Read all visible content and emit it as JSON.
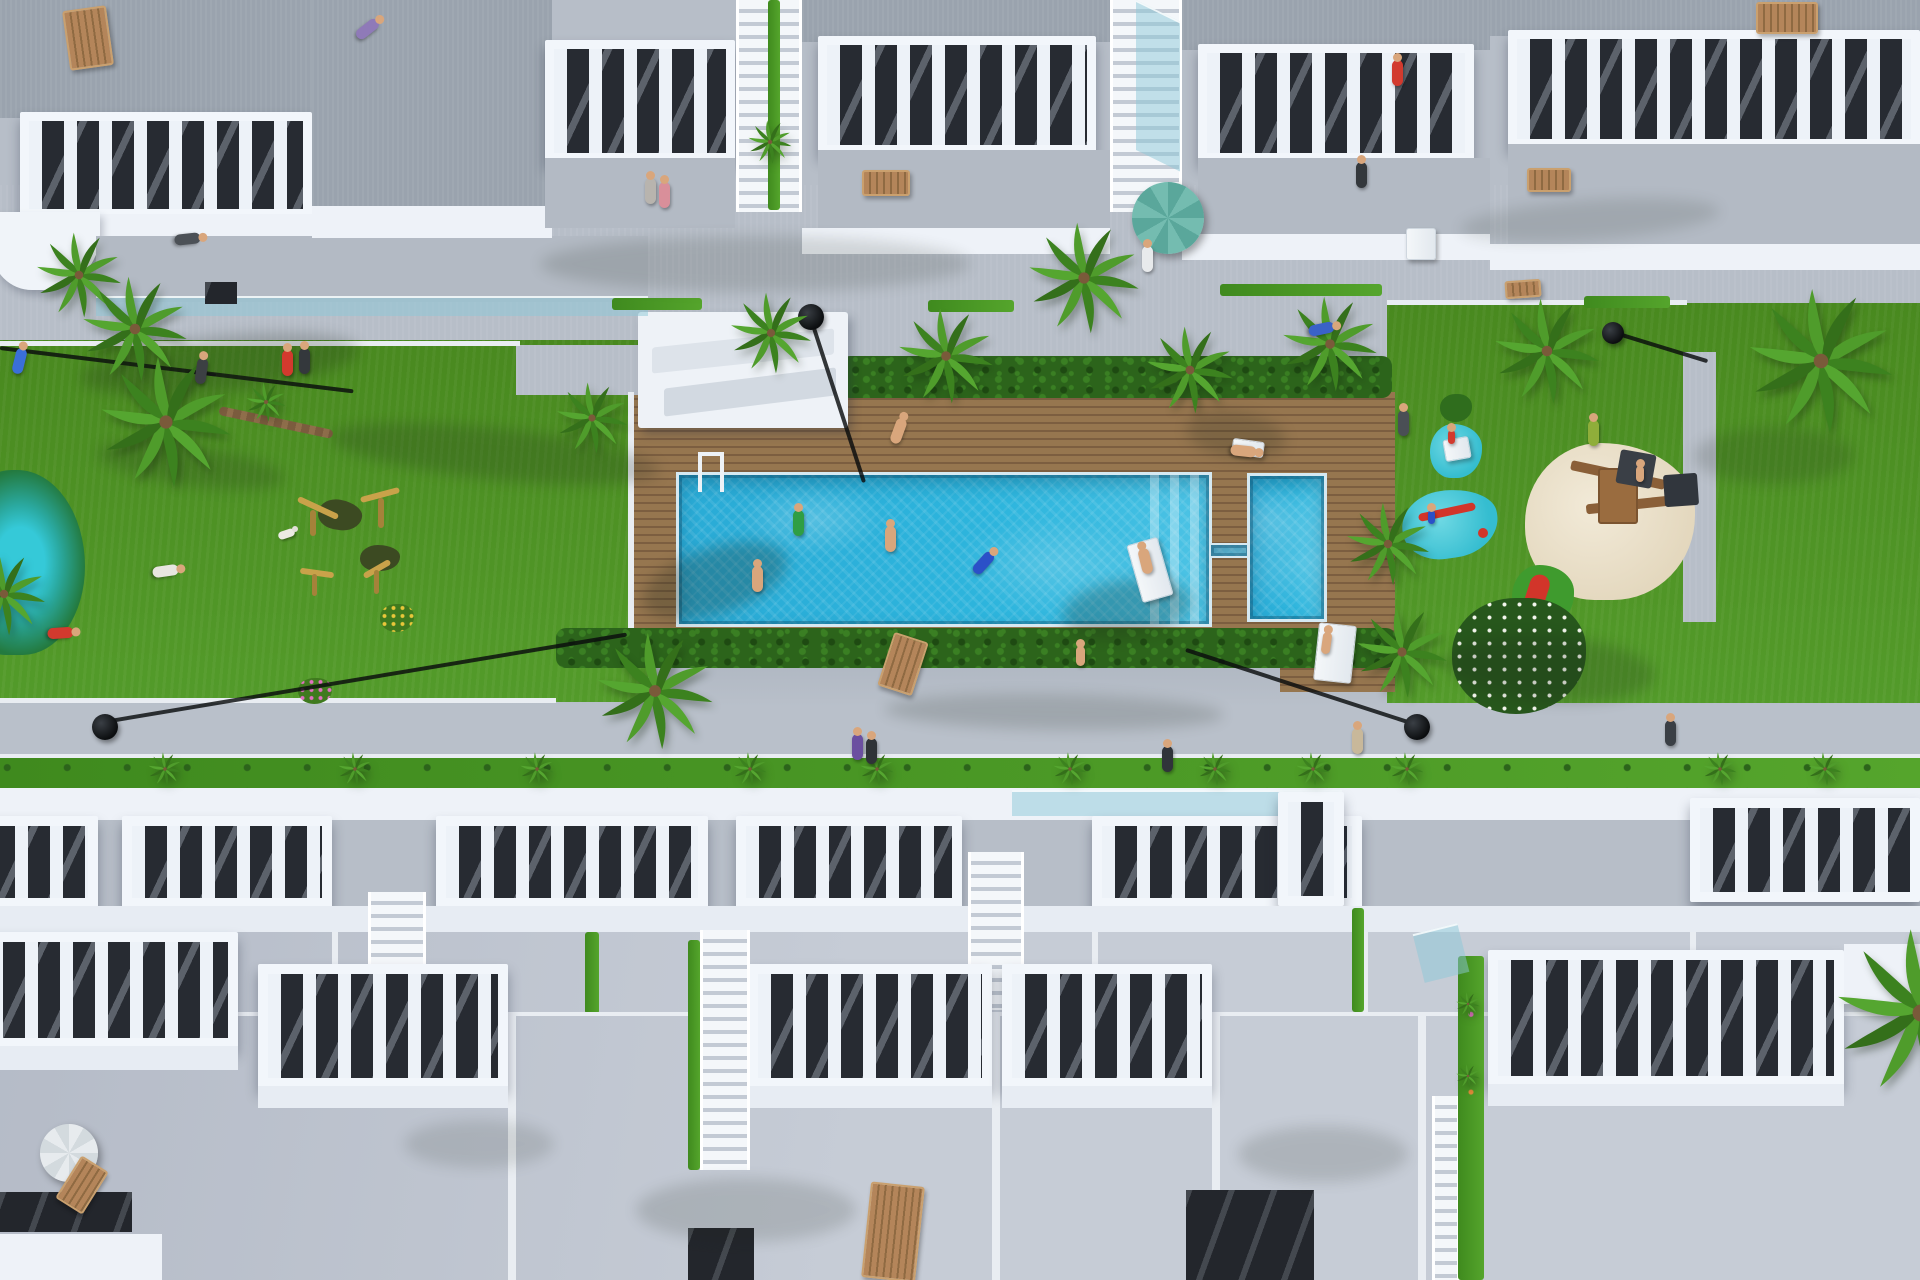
{
  "palette": {
    "grass": "#4f9428",
    "grass_dark": "#3a7a1d",
    "sidewalk": "#b7bec8",
    "sidewalk_shadow": "#99a2ae",
    "deck_wood": "#96764f",
    "deck_wood_dark": "#7c5e40",
    "pool_water": "#2db5dd",
    "pool_water_light": "#7fd6ea",
    "pool_coping": "#d5e9f2",
    "hedge_green": "#2c641b",
    "building_white": "#eef2f8",
    "roof_gray": "#9aa3ae",
    "roof_light": "#c6ccd6",
    "balcony_interior": "#272b32",
    "sand": "#e9dfc9",
    "splash_pad": "#3fc3d4",
    "play_red": "#d2352a",
    "wood_furniture": "#a97c4f",
    "parasol_teal": "#5aa79b",
    "lamp_black": "#0c0e10"
  },
  "scene": {
    "shadows": [
      {
        "x": 80,
        "y": 336,
        "w": 280,
        "h": 56,
        "r": -6,
        "o": 0.22
      },
      {
        "x": 330,
        "y": 428,
        "w": 330,
        "h": 52,
        "r": 6,
        "o": 0.2
      },
      {
        "x": 640,
        "y": 548,
        "w": 150,
        "h": 66,
        "r": -18,
        "o": 0.26
      },
      {
        "x": 1062,
        "y": 580,
        "w": 130,
        "h": 58,
        "r": -8,
        "o": 0.24
      },
      {
        "x": 1186,
        "y": 412,
        "w": 100,
        "h": 46,
        "r": 8,
        "o": 0.2
      },
      {
        "x": 540,
        "y": 236,
        "w": 430,
        "h": 56,
        "o": 0.14
      },
      {
        "x": 1445,
        "y": 636,
        "w": 210,
        "h": 66,
        "r": 4,
        "o": 0.2
      },
      {
        "x": 884,
        "y": 694,
        "w": 340,
        "h": 36,
        "r": 1,
        "o": 0.16
      },
      {
        "x": 1694,
        "y": 428,
        "w": 160,
        "h": 56,
        "o": 0.16
      },
      {
        "x": 636,
        "y": 1178,
        "w": 220,
        "h": 64,
        "o": 0.14
      },
      {
        "x": 1238,
        "y": 1126,
        "w": 170,
        "h": 56,
        "o": 0.14
      },
      {
        "x": 404,
        "y": 1120,
        "w": 150,
        "h": 48,
        "o": 0.12
      },
      {
        "x": 1460,
        "y": 200,
        "w": 260,
        "h": 40,
        "r": -4,
        "o": 0.12
      },
      {
        "x": 96,
        "y": 446,
        "w": 190,
        "h": 40,
        "r": 8,
        "o": 0.18
      }
    ],
    "palms": [
      {
        "x": 730,
        "y": 292,
        "w": 82,
        "h": 82
      },
      {
        "x": 898,
        "y": 308,
        "w": 96,
        "h": 96
      },
      {
        "x": 1028,
        "y": 222,
        "w": 112,
        "h": 112
      },
      {
        "x": 1146,
        "y": 326,
        "w": 88,
        "h": 88
      },
      {
        "x": 1282,
        "y": 296,
        "w": 96,
        "h": 96
      },
      {
        "x": 1494,
        "y": 298,
        "w": 106,
        "h": 106
      },
      {
        "x": 1748,
        "y": 288,
        "w": 146,
        "h": 146
      },
      {
        "x": 36,
        "y": 232,
        "w": 86,
        "h": 86
      },
      {
        "x": 82,
        "y": 276,
        "w": 106,
        "h": 106
      },
      {
        "x": 100,
        "y": 356,
        "w": 132,
        "h": 132
      },
      {
        "x": 246,
        "y": 382,
        "w": 40,
        "h": 40
      },
      {
        "x": 556,
        "y": 382,
        "w": 72,
        "h": 72
      },
      {
        "x": 596,
        "y": 632,
        "w": 118,
        "h": 118
      },
      {
        "x": 1346,
        "y": 502,
        "w": 84,
        "h": 84
      },
      {
        "x": 1356,
        "y": 606,
        "w": 92,
        "h": 92
      },
      {
        "x": -38,
        "y": 552,
        "w": 84,
        "h": 84
      },
      {
        "x": 1836,
        "y": 928,
        "w": 170,
        "h": 170
      },
      {
        "x": 748,
        "y": 120,
        "w": 44,
        "h": 44
      },
      {
        "x": 148,
        "y": 752,
        "w": 34,
        "h": 34
      },
      {
        "x": 338,
        "y": 752,
        "w": 34,
        "h": 34
      },
      {
        "x": 520,
        "y": 752,
        "w": 34,
        "h": 34
      },
      {
        "x": 733,
        "y": 752,
        "w": 34,
        "h": 34
      },
      {
        "x": 860,
        "y": 752,
        "w": 34,
        "h": 34
      },
      {
        "x": 1053,
        "y": 752,
        "w": 34,
        "h": 34
      },
      {
        "x": 1198,
        "y": 752,
        "w": 34,
        "h": 34
      },
      {
        "x": 1296,
        "y": 752,
        "w": 34,
        "h": 34
      },
      {
        "x": 1390,
        "y": 752,
        "w": 34,
        "h": 34
      },
      {
        "x": 1703,
        "y": 752,
        "w": 34,
        "h": 34
      },
      {
        "x": 1808,
        "y": 752,
        "w": 34,
        "h": 34
      },
      {
        "x": 1456,
        "y": 992,
        "w": 24,
        "h": 24
      },
      {
        "x": 1456,
        "y": 1064,
        "w": 24,
        "h": 24
      }
    ],
    "people": [
      {
        "x": 362,
        "y": 16,
        "r": 52,
        "c": "#8f7ab8"
      },
      {
        "x": 182,
        "y": 226,
        "r": 84,
        "c": "#4c5157"
      },
      {
        "x": 14,
        "y": 348,
        "r": 14,
        "c": "#3a6fd8"
      },
      {
        "x": 196,
        "y": 358,
        "r": 8,
        "c": "#3c4043"
      },
      {
        "x": 282,
        "y": 350,
        "c": "#d23a2e"
      },
      {
        "x": 299,
        "y": 348,
        "c": "#34383c"
      },
      {
        "x": 645,
        "y": 178,
        "c": "#b8b4ae"
      },
      {
        "x": 659,
        "y": 182,
        "c": "#d98f9a"
      },
      {
        "x": 1142,
        "y": 246,
        "c": "#e8eaec"
      },
      {
        "x": 1392,
        "y": 60,
        "c": "#d23a2e"
      },
      {
        "x": 1356,
        "y": 162,
        "c": "#34383c"
      },
      {
        "x": 893,
        "y": 418,
        "r": 20,
        "c": "#d9a67c"
      },
      {
        "x": 1238,
        "y": 438,
        "r": 96,
        "c": "#d9a67c"
      },
      {
        "x": 793,
        "y": 510,
        "c": "#2f9e44"
      },
      {
        "x": 885,
        "y": 526,
        "c": "#d9a67c"
      },
      {
        "x": 752,
        "y": 566,
        "c": "#d9a67c"
      },
      {
        "x": 978,
        "y": 550,
        "r": 42,
        "c": "#2b50c8"
      },
      {
        "x": 1140,
        "y": 548,
        "r": -14,
        "c": "#d9a67c"
      },
      {
        "x": 1076,
        "y": 646,
        "w": 9,
        "h": 20,
        "c": "#d9a67c"
      },
      {
        "x": 1322,
        "y": 632,
        "r": 8,
        "w": 9,
        "h": 22,
        "c": "#d9a67c"
      },
      {
        "x": 1316,
        "y": 316,
        "r": 78,
        "c": "#3a62c8"
      },
      {
        "x": 1398,
        "y": 410,
        "c": "#4a4f55"
      },
      {
        "x": 1588,
        "y": 420,
        "c": "#8fae3a"
      },
      {
        "x": 1448,
        "y": 430,
        "w": 7,
        "h": 14,
        "c": "#d23a2e"
      },
      {
        "x": 1428,
        "y": 510,
        "w": 7,
        "h": 14,
        "c": "#2b50c8"
      },
      {
        "x": 1636,
        "y": 466,
        "w": 8,
        "h": 16,
        "c": "#d9a67c"
      },
      {
        "x": 55,
        "y": 620,
        "r": 86,
        "c": "#d23a2e"
      },
      {
        "x": 160,
        "y": 558,
        "r": 82,
        "c": "#e8e6e0"
      },
      {
        "x": 852,
        "y": 734,
        "c": "#6b4fa0"
      },
      {
        "x": 866,
        "y": 738,
        "c": "#2f3337"
      },
      {
        "x": 1162,
        "y": 746,
        "c": "#30343a"
      },
      {
        "x": 1352,
        "y": 728,
        "c": "#c8b89a"
      },
      {
        "x": 1665,
        "y": 720,
        "c": "#3a3f45"
      }
    ],
    "loungers_wood": [
      {
        "x": 66,
        "y": 8,
        "w": 44,
        "h": 60,
        "r": -8
      },
      {
        "x": 862,
        "y": 170,
        "w": 48,
        "h": 26
      },
      {
        "x": 1756,
        "y": 2,
        "w": 62,
        "h": 32
      },
      {
        "x": 1527,
        "y": 168,
        "w": 44,
        "h": 24
      },
      {
        "x": 1505,
        "y": 280,
        "w": 36,
        "h": 18,
        "r": -4
      },
      {
        "x": 885,
        "y": 636,
        "w": 36,
        "h": 56,
        "r": 18
      },
      {
        "x": 66,
        "y": 1160,
        "w": 32,
        "h": 50,
        "r": 32
      },
      {
        "x": 866,
        "y": 1184,
        "w": 54,
        "h": 96,
        "r": 6
      }
    ],
    "loungers_white": [
      {
        "x": 1316,
        "y": 624,
        "w": 38,
        "h": 58,
        "r": 6
      },
      {
        "x": 1134,
        "y": 540,
        "w": 32,
        "h": 60,
        "r": -16
      },
      {
        "x": 1232,
        "y": 440,
        "w": 32,
        "h": 16,
        "r": 8
      },
      {
        "x": 1406,
        "y": 228,
        "w": 30,
        "h": 32
      },
      {
        "x": 1444,
        "y": 438,
        "w": 26,
        "h": 22,
        "r": -10
      }
    ]
  }
}
